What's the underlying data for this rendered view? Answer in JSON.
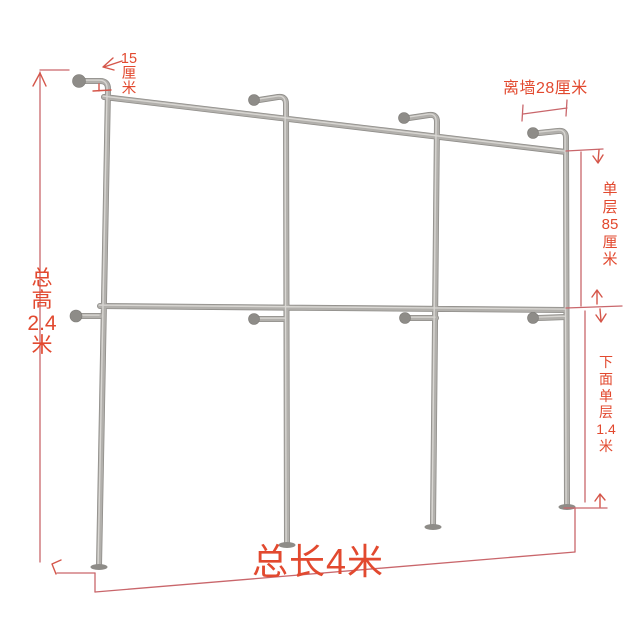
{
  "diagram": {
    "labels": {
      "top_offset": "15\n厘\n米",
      "wall_distance": "离墙28厘米",
      "total_height": "总\n高\n2.4\n米",
      "upper_layer": "单\n层\n85\n厘\n米",
      "lower_layer": "下\n面\n单\n层\n1.4\n米",
      "total_length": "总长4米"
    },
    "colors": {
      "label_text": "#e2492f",
      "dimension_line": "#c9666b",
      "arrow": "#d5564a",
      "pipe_shadow": "#8f8d89",
      "pipe_base": "#b2b0ac",
      "pipe_highlight": "#d9d7d3",
      "flange": "#8e8c88",
      "background": "#ffffff"
    }
  }
}
